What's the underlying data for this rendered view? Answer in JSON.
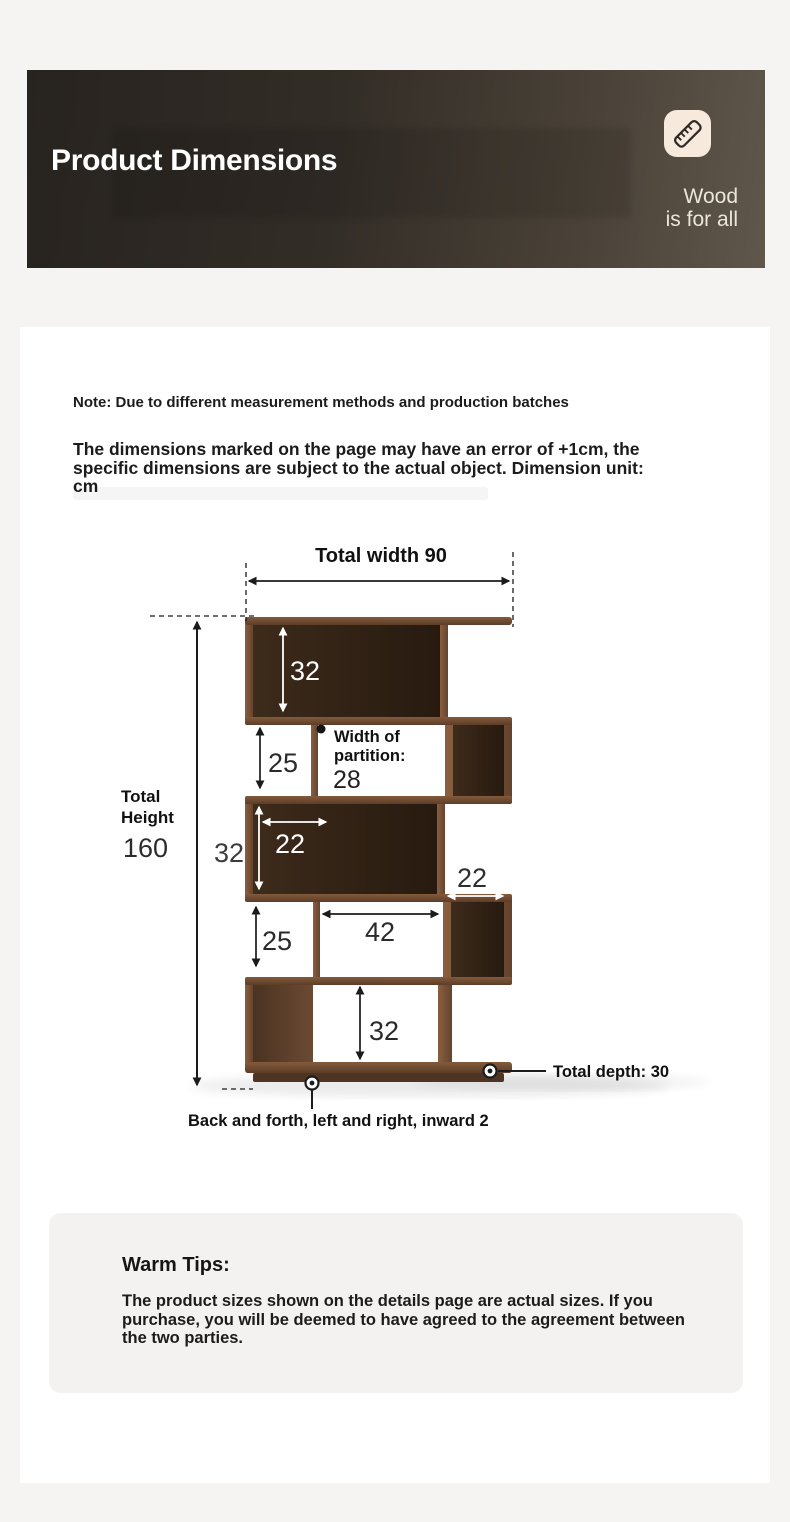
{
  "banner": {
    "title": "Product Dimensions",
    "tagline_line1": "Wood",
    "tagline_line2": "is for all",
    "icon": "ruler-icon",
    "bg_left_color": "#27231f",
    "bg_right_color": "#5f574b",
    "icon_bg_color": "#f8e9dd"
  },
  "notes": {
    "note": "Note: Due to different measurement methods and production batches",
    "disclaimer": "The dimensions marked on the page may have an error of +1cm, the specific dimensions are subject to the actual object. Dimension unit: cm"
  },
  "diagram": {
    "total_width": "Total width 90",
    "total_height_word1": "Total",
    "total_height_word2": "Height",
    "total_height_value": "160",
    "partition_word1": "Width of",
    "partition_word2": "partition:",
    "partition_value": "28",
    "row1_height": "32",
    "row2_height": "25",
    "row3_width": "22",
    "row3_height": "32",
    "row4_height": "25",
    "row4_middle_width": "42",
    "row4_right_width": "22",
    "row5_height": "32",
    "depth_note": "Total depth: 30",
    "inset_note": "Back and forth, left and right, inward 2",
    "wood_frame_color": "#7c5338",
    "wood_dark_color": "#2e1f14"
  },
  "warm_tips": {
    "title": "Warm Tips:",
    "body": "The product sizes shown on the details page are actual sizes. If you purchase, you will be deemed to have agreed to the agreement between the two parties."
  }
}
